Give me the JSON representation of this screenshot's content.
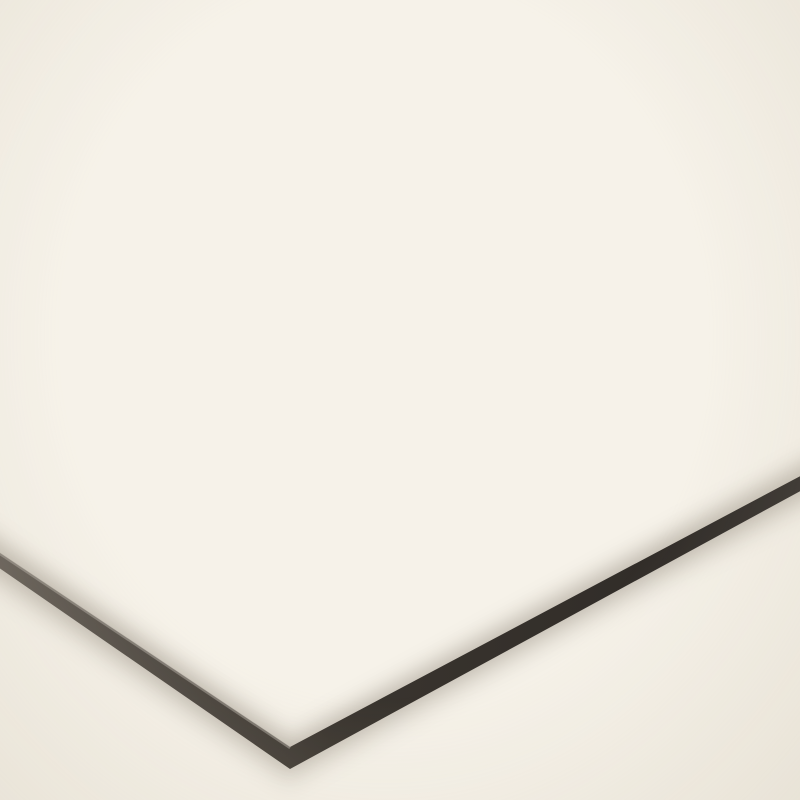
{
  "scene": {
    "type": "product photo",
    "subject": "Model airport diorama ground mat (apron, taxiways and runway) shown tilted on a cream background",
    "view": "perspective view with the near corner of the rigid mat pointing toward the viewer",
    "visible_text": ""
  },
  "colors": {
    "bg": "#f6f2e9",
    "apron": "#b6b8ba",
    "apron_far": "#c2c4c5",
    "grid": "#686c71",
    "runway": "#37424a",
    "white": "#f2f3f3",
    "red": "#cb1f2e",
    "orange": "#f29a2e",
    "bar": "#141414",
    "side_dark": "#2b2724",
    "side_light": "#6e675f",
    "shadow": "#7a7164"
  },
  "markings": {
    "counts": {
      "gate_clusters": 2,
      "stand_bars_per_cluster": 10,
      "stop_diamonds": 6,
      "runway_arrows": 4,
      "road_arrows": 2,
      "zebra_crossings": 2,
      "white_box_ladders": 2,
      "red_hatch_zones": 2,
      "red_edge_combs": 2,
      "service_roads": 2
    },
    "stop_diamond_positions": [
      [
        165,
        330
      ],
      [
        420,
        290
      ],
      [
        445,
        405
      ],
      [
        700,
        300
      ],
      [
        900,
        290
      ],
      [
        920,
        405
      ]
    ],
    "gate_clusters": [
      {
        "origin": [
          238,
          110
        ],
        "scale_x": 1.0
      },
      {
        "origin": [
          762,
          96
        ],
        "scale_x": 0.82
      }
    ],
    "stand_bar_offsets": [
      [
        18,
        0,
        58
      ],
      [
        92,
        10,
        72
      ],
      [
        180,
        20,
        56
      ],
      [
        40,
        32,
        66
      ],
      [
        122,
        42,
        78
      ],
      [
        214,
        52,
        58
      ],
      [
        62,
        64,
        70
      ],
      [
        150,
        74,
        62
      ],
      [
        -28,
        28,
        34
      ],
      [
        -20,
        58,
        40
      ]
    ]
  },
  "geometry": {
    "flat_size": [
      1000,
      700
    ],
    "screen_corners": {
      "far_left": [
        -115,
        476
      ],
      "top": [
        505,
        244
      ],
      "right": [
        872,
        438
      ],
      "near_bottom": [
        290,
        747
      ]
    }
  }
}
